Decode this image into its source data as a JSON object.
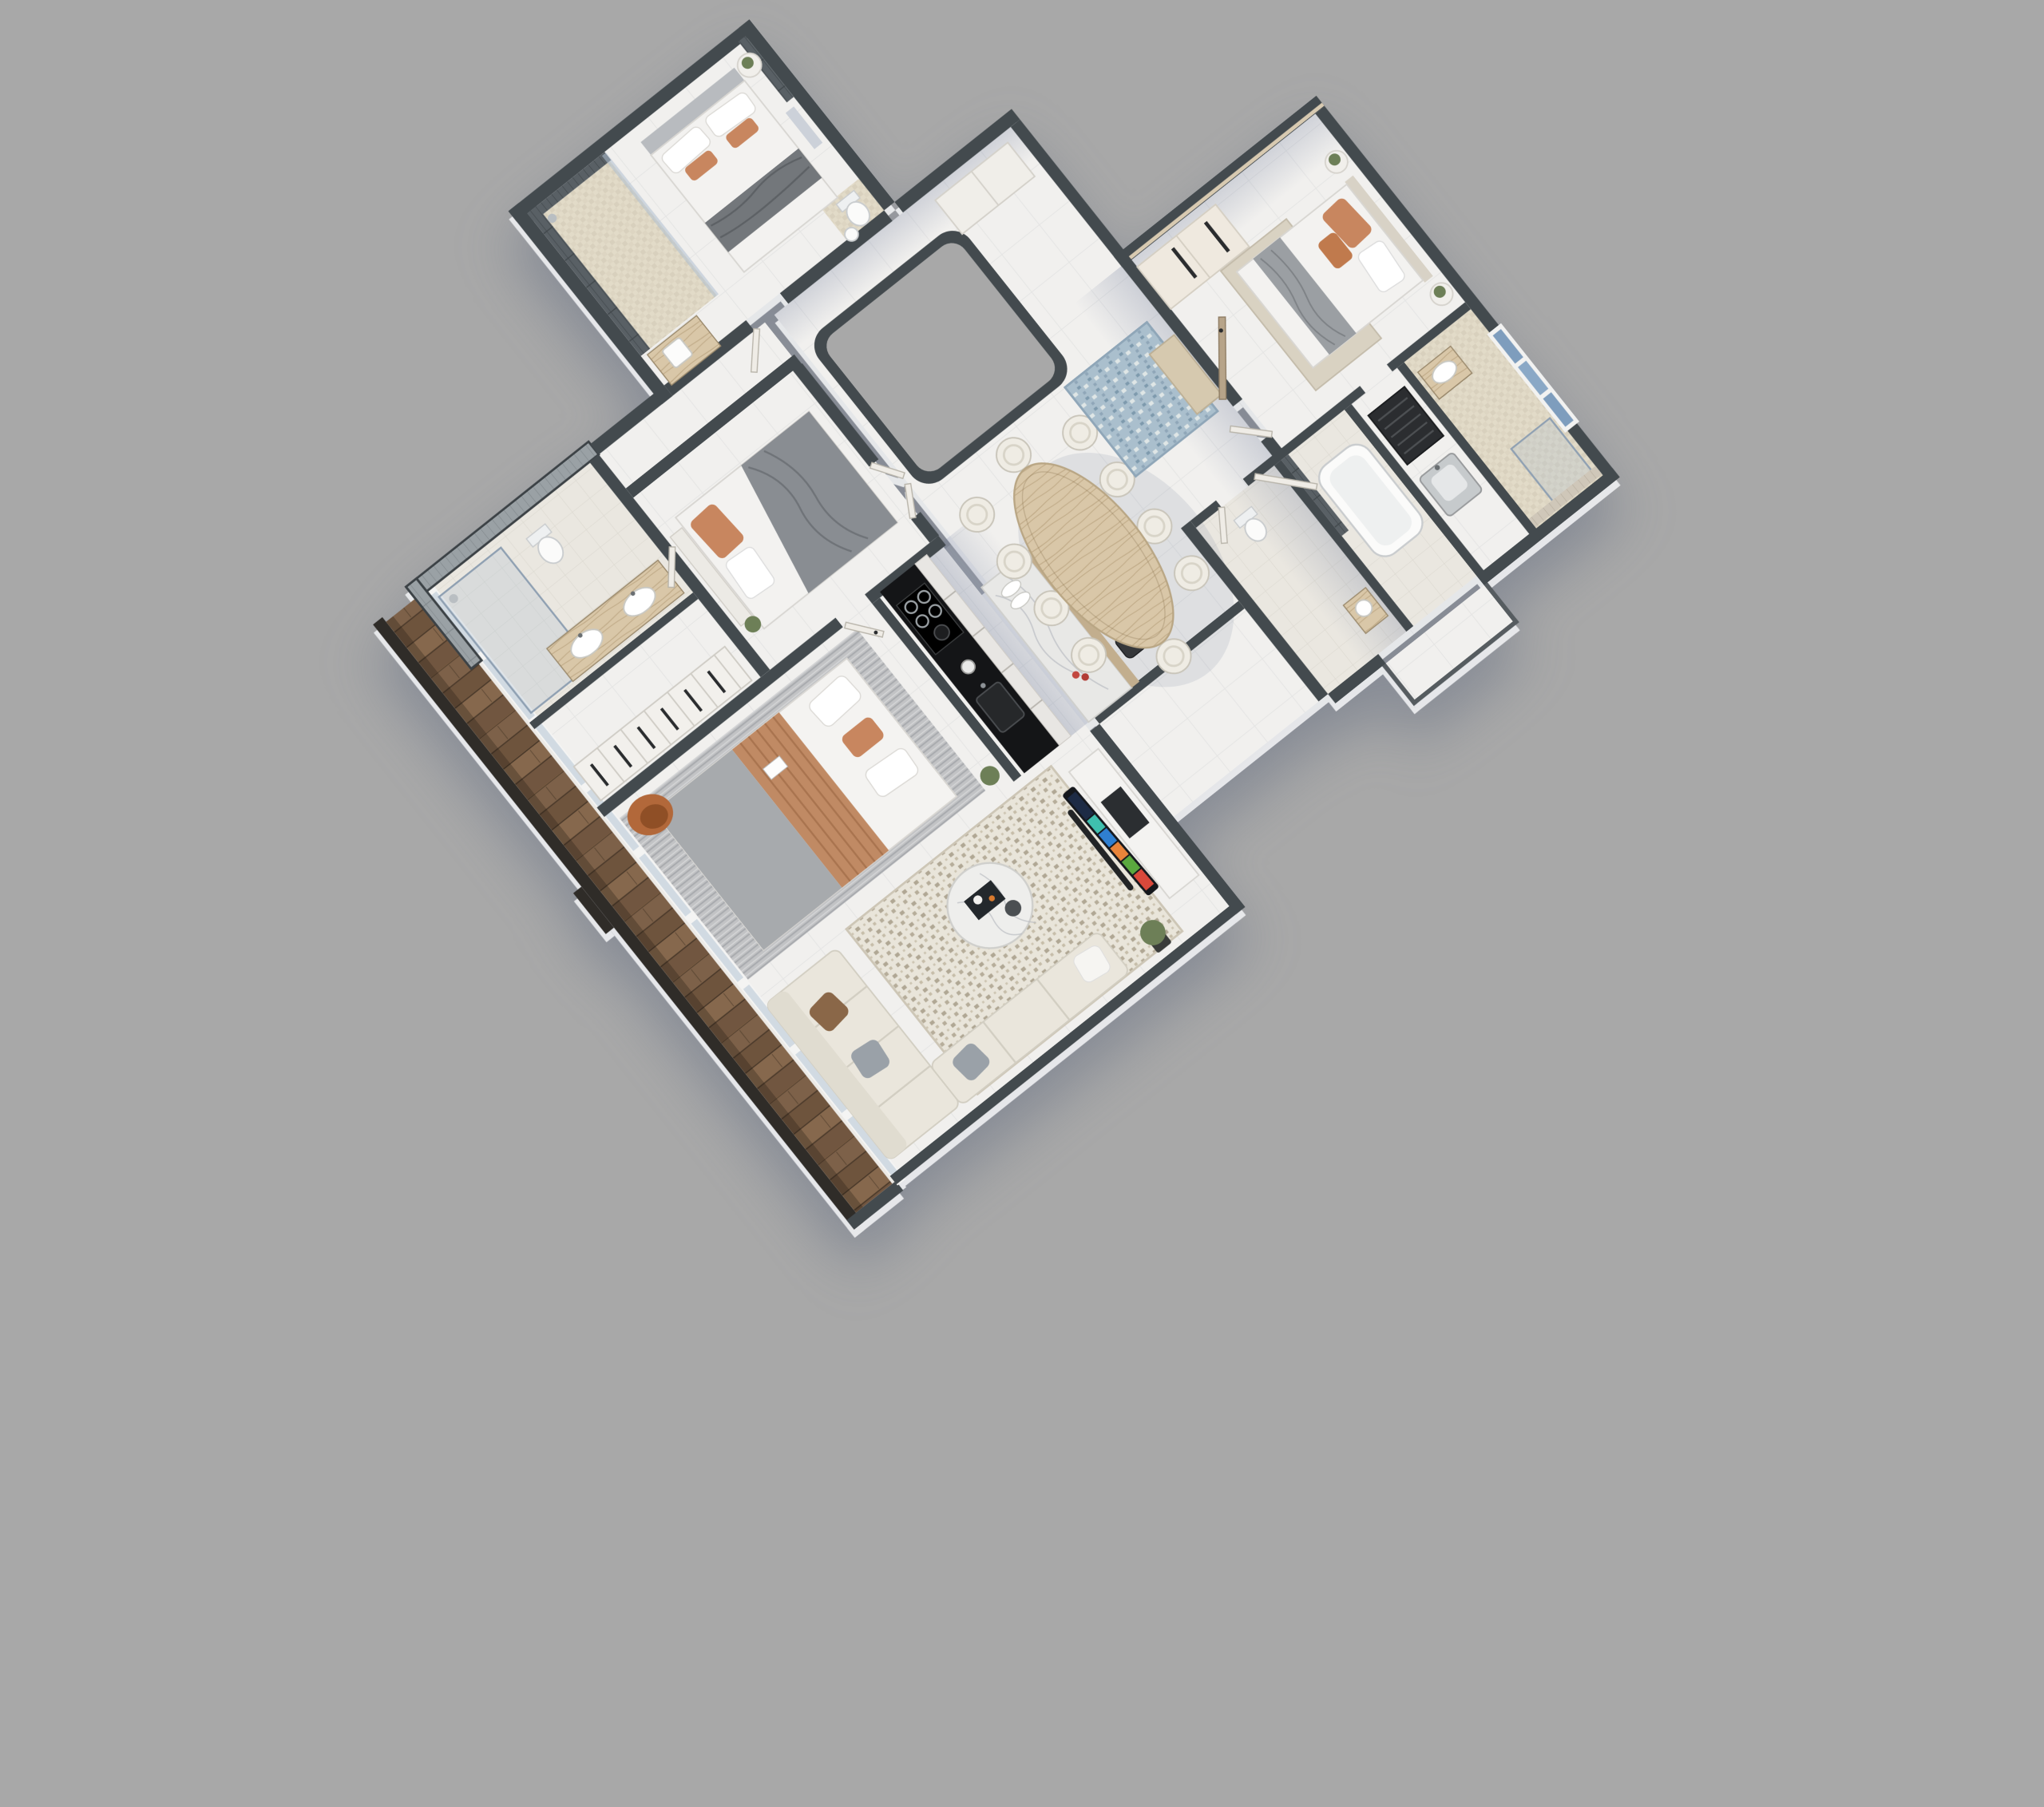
{
  "scene": {
    "type": "isometric-3d-floor-plan-rendering",
    "description": "Top-down 3D cutaway render of a 4-bedroom apartment on a plain gray backdrop, rotated ~38 degrees",
    "counts": {
      "bedrooms": 4,
      "dining_chairs": 10,
      "bar_stools": 4,
      "closet_doors": 6,
      "facade_panes": 9
    },
    "rooms": [
      {
        "name": "balcony",
        "furniture": [
          "wood plank deck",
          "glass sliding facade"
        ]
      },
      {
        "name": "master-bathroom",
        "furniture": [
          "walk-in shower",
          "toilet",
          "double-basin wood vanity",
          "gray tiled feature wall"
        ]
      },
      {
        "name": "walk-in-closet",
        "furniture": [
          "wardrobe row with six doors"
        ]
      },
      {
        "name": "bedroom-2",
        "furniture": [
          "double bed with gray quilt and terracotta pillows",
          "headboard bench",
          "plant"
        ]
      },
      {
        "name": "master-bedroom",
        "furniture": [
          "double bed with terracotta throw",
          "striped rug",
          "orange leather armchair",
          "open book"
        ]
      },
      {
        "name": "kitchen",
        "furniture": [
          "black counter with gas cooktop and sink",
          "white drawer fronts",
          "marble island",
          "four bar stools",
          "bowls",
          "flowers"
        ]
      },
      {
        "name": "dining-area",
        "furniture": [
          "oval light-wood table",
          "ten white tub chairs"
        ]
      },
      {
        "name": "living-room",
        "furniture": [
          "L-shaped cream sofa",
          "round marble coffee table",
          "mosaic textured rug",
          "curved TV on console",
          "floor plant"
        ]
      },
      {
        "name": "entry-hall",
        "furniture": [
          "blue patterned rug",
          "beige door mat",
          "entry door",
          "hall cabinet",
          "core void"
        ]
      },
      {
        "name": "bedroom-1",
        "furniture": [
          "double bed with gray headboard and terracotta pillows",
          "round side table with plant",
          "wall art",
          "dark tiled ensuite shower",
          "wood vanity with basin",
          "WC"
        ]
      },
      {
        "name": "powder-room",
        "furniture": [
          "toilet",
          "small vanity"
        ]
      },
      {
        "name": "bathroom-2",
        "furniture": [
          "bathtub",
          "dark tile accent"
        ]
      },
      {
        "name": "utility-room",
        "furniture": [
          "appliance",
          "stainless sink"
        ]
      },
      {
        "name": "bedroom-3",
        "furniture": [
          "double bed with beige headboard",
          "cream wardrobe with long handles",
          "two round side tables with plants",
          "beige rug"
        ]
      },
      {
        "name": "ensuite-3",
        "furniture": [
          "wood vanity with basin",
          "glass shower",
          "blue window"
        ]
      }
    ],
    "colors": {
      "bg": "#a8a8a8",
      "wall-dark": "#434a4e",
      "floor-white": "#f1f0ee",
      "shadow-blue": "#6f7f9e",
      "wood-deck": "#7a5e45",
      "counter-black": "#141517",
      "drawer-white": "#e8e6e3",
      "marble": "#e8e8e6",
      "island-wood": "#c2ae8e",
      "dining-wood": "#d8c6a8",
      "seat-cream": "#efece4",
      "sofa-cream": "#eae6dc",
      "rug-base": "#e7e3d8",
      "rug-speck": "#b4ab98",
      "terracotta": "#c08a64",
      "pillow-orange": "#c8865f",
      "gray-throw": "#73777b",
      "duvet-white": "#f3f2f0",
      "chair-orange": "#b2683a",
      "rug-blue": "#a4bac8",
      "mat-beige": "#d6c9af",
      "tile-dark": "#596065",
      "tile-gray": "#9aa1a5",
      "tile-beige": "#cfc7b9",
      "vanity-wood": "#c4b49b",
      "glass": "#aebfd1",
      "stool-dark": "#35373a",
      "plant": "#6d7f57",
      "tv-navy": "#1d2b45",
      "tv-teal": "#3fbfae",
      "tv-orange": "#e8843a",
      "tv-red": "#d9483b"
    }
  }
}
